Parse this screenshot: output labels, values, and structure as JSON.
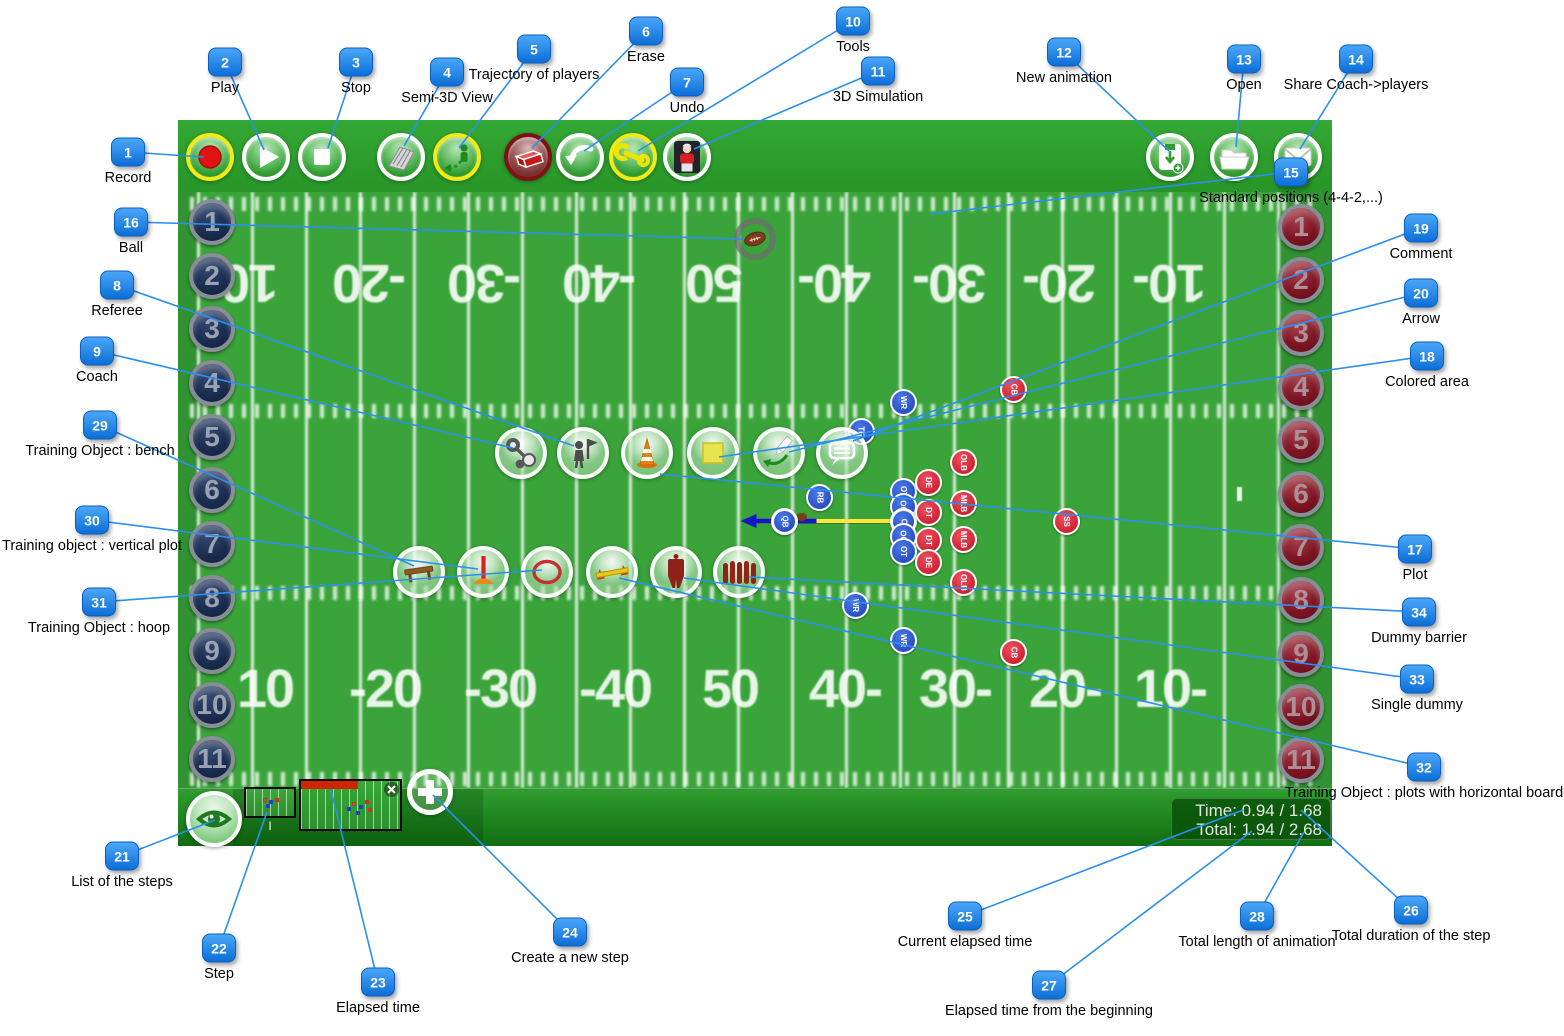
{
  "colors": {
    "accent_blue": "#1583f0",
    "line_blue": "#2b8ff0",
    "toolbar_green": "#2f9e2f",
    "field_green": "#3aa43a",
    "progress_red": "#cf2505",
    "yellow_ring": "#f0ea16"
  },
  "toolbar": {
    "buttons": [
      {
        "name": "record",
        "icon": "record",
        "ring": "yellow",
        "cx": 210
      },
      {
        "name": "play",
        "icon": "play",
        "ring": "white",
        "cx": 266
      },
      {
        "name": "stop",
        "icon": "stop",
        "ring": "white",
        "cx": 322
      },
      {
        "name": "semi-3d-view",
        "icon": "semi3d",
        "ring": "white",
        "cx": 401
      },
      {
        "name": "trajectory-of-players",
        "icon": "trajectory",
        "ring": "yellow",
        "cx": 457
      },
      {
        "name": "erase",
        "icon": "erase",
        "ring": "darkred",
        "cx": 528
      },
      {
        "name": "undo",
        "icon": "undo",
        "ring": "white",
        "cx": 580
      },
      {
        "name": "tools",
        "icon": "wrench",
        "ring": "yellow",
        "cx": 633
      },
      {
        "name": "3d-simulation",
        "icon": "sim3d",
        "ring": "white",
        "cx": 687
      },
      {
        "name": "new-animation",
        "icon": "newanim",
        "ring": "white",
        "cx": 1170
      },
      {
        "name": "open",
        "icon": "folder",
        "ring": "white",
        "cx": 1234
      },
      {
        "name": "share-coach-players",
        "icon": "envelope",
        "ring": "white",
        "cx": 1298
      }
    ]
  },
  "field": {
    "left_players": [
      "1",
      "2",
      "3",
      "4",
      "5",
      "6",
      "7",
      "8",
      "9",
      "10",
      "11"
    ],
    "right_players": [
      "1",
      "2",
      "3",
      "4",
      "5",
      "6",
      "7",
      "8",
      "9",
      "10",
      "11"
    ],
    "left_token_ys": [
      222,
      276,
      329,
      383,
      437,
      490,
      544,
      598,
      651,
      705,
      759
    ],
    "right_token_ys": [
      227,
      280,
      333,
      387,
      440,
      494,
      547,
      600,
      654,
      707,
      760
    ],
    "yard_numbers_bottom": [
      "10",
      "-20",
      "-30",
      "-40",
      "50",
      "40-",
      "30-",
      "20-",
      "10-"
    ],
    "yard_numbers_top": [
      "10",
      "-20",
      "-30",
      "-40",
      "50",
      "40-",
      "30-",
      "20-",
      "10-"
    ],
    "bottom_x": [
      265,
      385,
      500,
      615,
      730,
      845,
      955,
      1065,
      1170
    ],
    "top_x": [
      250,
      370,
      485,
      600,
      715,
      835,
      950,
      1060,
      1170
    ]
  },
  "tool_circles": {
    "cy1": 453,
    "row1": [
      {
        "name": "coach-whistle",
        "icon": "whistle",
        "cx": 521
      },
      {
        "name": "referee",
        "icon": "referee",
        "cx": 583
      },
      {
        "name": "plot-cone",
        "icon": "cone",
        "cx": 647
      },
      {
        "name": "colored-area",
        "icon": "area",
        "cx": 713
      },
      {
        "name": "arrow-tool",
        "icon": "arrowdraw",
        "cx": 779
      },
      {
        "name": "comment",
        "icon": "comment",
        "cx": 842
      }
    ],
    "cy2": 572,
    "row2": [
      {
        "name": "bench",
        "icon": "bench",
        "cx": 419
      },
      {
        "name": "vertical-plot",
        "icon": "vplot",
        "cx": 483
      },
      {
        "name": "hoop",
        "icon": "hoop",
        "cx": 547
      },
      {
        "name": "plots-horizontal-board",
        "icon": "hboard",
        "cx": 612
      },
      {
        "name": "single-dummy",
        "icon": "dummy",
        "cx": 676
      },
      {
        "name": "dummy-barrier",
        "icon": "barrier",
        "cx": 739
      }
    ]
  },
  "formation": {
    "offense": [
      {
        "label": "WR",
        "x": 903,
        "y": 402
      },
      {
        "label": "TE",
        "x": 861,
        "y": 431
      },
      {
        "label": "RB",
        "x": 819,
        "y": 497
      },
      {
        "label": "QB",
        "x": 784,
        "y": 521,
        "hl": true
      },
      {
        "label": "OT",
        "x": 903,
        "y": 491
      },
      {
        "label": "OG",
        "x": 903,
        "y": 506
      },
      {
        "label": "C",
        "x": 903,
        "y": 521,
        "hl": true
      },
      {
        "label": "OG",
        "x": 903,
        "y": 536
      },
      {
        "label": "OT",
        "x": 903,
        "y": 551
      },
      {
        "label": "WR",
        "x": 855,
        "y": 605
      },
      {
        "label": "WR",
        "x": 903,
        "y": 640
      }
    ],
    "defense": [
      {
        "label": "CB",
        "x": 1013,
        "y": 389
      },
      {
        "label": "OLB",
        "x": 963,
        "y": 462
      },
      {
        "label": "DE",
        "x": 928,
        "y": 482
      },
      {
        "label": "MLB",
        "x": 963,
        "y": 503
      },
      {
        "label": "DT",
        "x": 928,
        "y": 512
      },
      {
        "label": "SS",
        "x": 1066,
        "y": 521
      },
      {
        "label": "MLB",
        "x": 963,
        "y": 539
      },
      {
        "label": "DT",
        "x": 928,
        "y": 540
      },
      {
        "label": "DE",
        "x": 928,
        "y": 562
      },
      {
        "label": "OLB",
        "x": 963,
        "y": 582
      },
      {
        "label": "CB",
        "x": 1013,
        "y": 652
      }
    ]
  },
  "ball": {
    "x": 755,
    "y": 239
  },
  "play_marks": {
    "yellow_line": {
      "x1": 790,
      "y1": 521,
      "x2": 898,
      "y2": 521
    },
    "blue_arrow": {
      "x1": 815,
      "y1": 521,
      "x2": 746,
      "y2": 521
    },
    "goal_mark": {
      "x": 1237,
      "y": 487
    }
  },
  "steps": {
    "step1_label": "I",
    "elapsed_fraction": 0.56
  },
  "timebox": {
    "time_line": "Time: 0.94 / 1.68",
    "total_line": "Total: 1.94 / 2.68"
  },
  "callouts": [
    {
      "n": "1",
      "label": "Record",
      "bx": 128,
      "by": 152,
      "tx": 204,
      "ty": 157
    },
    {
      "n": "2",
      "label": "Play",
      "bx": 225,
      "by": 62,
      "tx": 264,
      "ty": 150
    },
    {
      "n": "3",
      "label": "Stop",
      "bx": 356,
      "by": 62,
      "tx": 328,
      "ty": 148
    },
    {
      "n": "4",
      "label": "Semi-3D View",
      "bx": 447,
      "by": 72,
      "tx": 404,
      "ty": 146
    },
    {
      "n": "5",
      "label": "Trajectory of players",
      "bx": 534,
      "by": 49,
      "tx": 459,
      "ty": 148
    },
    {
      "n": "6",
      "label": "Erase",
      "bx": 646,
      "by": 31,
      "tx": 532,
      "ty": 148
    },
    {
      "n": "7",
      "label": "Undo",
      "bx": 687,
      "by": 82,
      "tx": 584,
      "ty": 151
    },
    {
      "n": "8",
      "label": "Referee",
      "bx": 117,
      "by": 285,
      "tx": 574,
      "ty": 446
    },
    {
      "n": "9",
      "label": "Coach",
      "bx": 97,
      "by": 351,
      "tx": 513,
      "ty": 448
    },
    {
      "n": "10",
      "label": "Tools",
      "bx": 853,
      "by": 21,
      "tx": 638,
      "ty": 151
    },
    {
      "n": "11",
      "label": "3D Simulation",
      "bx": 878,
      "by": 71,
      "tx": 694,
      "ty": 149
    },
    {
      "n": "12",
      "label": "New animation",
      "bx": 1064,
      "by": 52,
      "tx": 1169,
      "ty": 151
    },
    {
      "n": "13",
      "label": "Open",
      "bx": 1244,
      "by": 59,
      "tx": 1236,
      "ty": 147
    },
    {
      "n": "14",
      "label": "Share Coach->players",
      "bx": 1356,
      "by": 59,
      "tx": 1300,
      "ty": 149
    },
    {
      "n": "15",
      "label": "Standard positions (4-4-2,...)",
      "bx": 1291,
      "by": 172,
      "tx": 930,
      "ty": 214
    },
    {
      "n": "16",
      "label": "Ball",
      "bx": 131,
      "by": 222,
      "tx": 744,
      "ty": 239
    },
    {
      "n": "17",
      "label": "Plot",
      "bx": 1415,
      "by": 549,
      "tx": 660,
      "ty": 474
    },
    {
      "n": "18",
      "label": "Colored area",
      "bx": 1427,
      "by": 356,
      "tx": 719,
      "ty": 457
    },
    {
      "n": "19",
      "label": "Comment",
      "bx": 1421,
      "by": 228,
      "tx": 853,
      "ty": 441
    },
    {
      "n": "20",
      "label": "Arrow",
      "bx": 1421,
      "by": 293,
      "tx": 789,
      "ty": 452
    },
    {
      "n": "21",
      "label": "List of the steps",
      "bx": 122,
      "by": 856,
      "tx": 215,
      "ty": 820
    },
    {
      "n": "22",
      "label": "Step",
      "bx": 219,
      "by": 948,
      "tx": 267,
      "ty": 812
    },
    {
      "n": "23",
      "label": "Elapsed time",
      "bx": 378,
      "by": 982,
      "tx": 331,
      "ty": 790
    },
    {
      "n": "24",
      "label": "Create a new step",
      "bx": 570,
      "by": 932,
      "tx": 433,
      "ty": 795
    },
    {
      "n": "25",
      "label": "Current elapsed time",
      "bx": 965,
      "by": 916,
      "tx": 1243,
      "ty": 810
    },
    {
      "n": "26",
      "label": "Total duration of the step",
      "bx": 1411,
      "by": 910,
      "tx": 1301,
      "ty": 810
    },
    {
      "n": "27",
      "label": "Elapsed time from the beginning",
      "bx": 1049,
      "by": 985,
      "tx": 1252,
      "ty": 831
    },
    {
      "n": "28",
      "label": "Total length of animation",
      "bx": 1257,
      "by": 916,
      "tx": 1304,
      "ty": 832
    },
    {
      "n": "29",
      "label": "Training Object : bench",
      "bx": 100,
      "by": 425,
      "tx": 414,
      "ty": 566
    },
    {
      "n": "30",
      "label": "Training object : vertical plot",
      "bx": 92,
      "by": 520,
      "tx": 478,
      "ty": 569
    },
    {
      "n": "31",
      "label": "Training Object :  hoop",
      "bx": 99,
      "by": 602,
      "tx": 542,
      "ty": 570
    },
    {
      "n": "32",
      "label": "Training Object : plots with horizontal board",
      "bx": 1424,
      "by": 767,
      "tx": 619,
      "ty": 578
    },
    {
      "n": "33",
      "label": "Single dummy",
      "bx": 1417,
      "by": 679,
      "tx": 684,
      "ty": 578
    },
    {
      "n": "34",
      "label": "Dummy barrier",
      "bx": 1419,
      "by": 612,
      "tx": 749,
      "ty": 577
    }
  ]
}
